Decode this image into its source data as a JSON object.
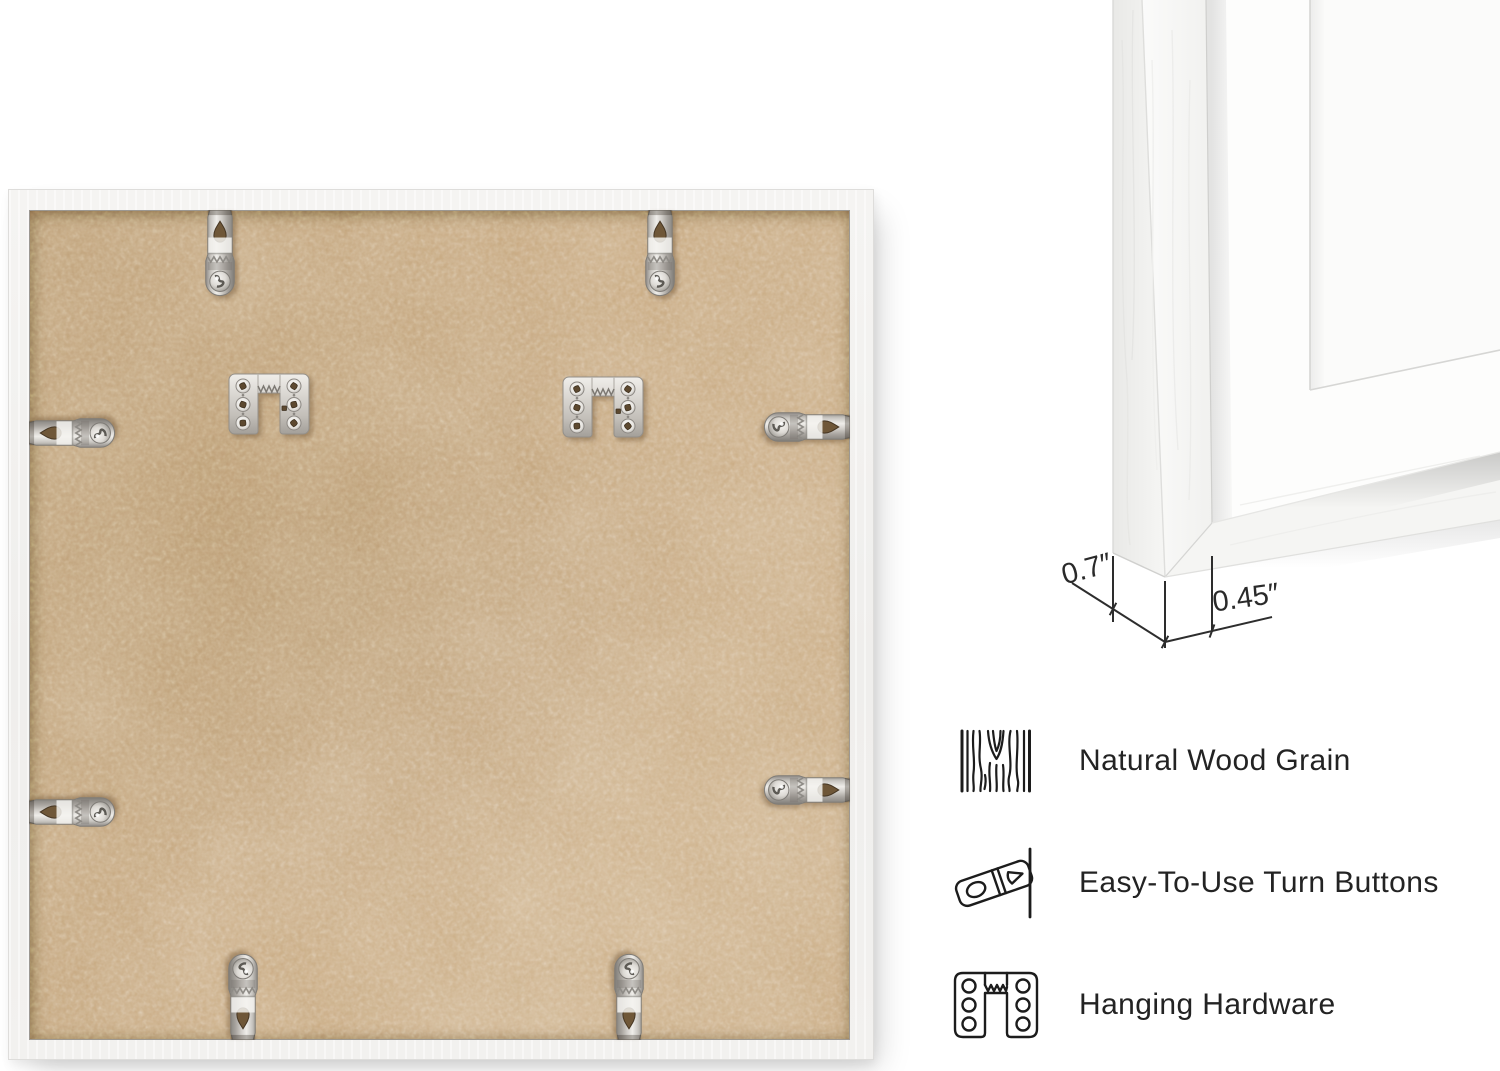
{
  "image_type": "product-infographic",
  "back_view": {
    "description_of_pixels": "rear of square white picture frame with MDF backing",
    "turn_button_count": 8,
    "sawtooth_hanger_count": 2
  },
  "corner_detail": {
    "dimensions": [
      {
        "name": "frame-depth",
        "label": "0.7″"
      },
      {
        "name": "frame-face-width",
        "label": "0.45″"
      }
    ]
  },
  "features": [
    {
      "icon": "wood-grain-icon",
      "label": "Natural Wood Grain"
    },
    {
      "icon": "turn-button-icon",
      "label": "Easy-To-Use Turn Buttons"
    },
    {
      "icon": "hanging-hardware-icon",
      "label": "Hanging Hardware"
    }
  ],
  "colors": {
    "background": "#ffffff",
    "frame_white": "#f3f2f0",
    "mdf_tan": "#c7a87f",
    "metal_silver": "#d6d3ce",
    "line_art": "#1c1c1c",
    "dimension_lines": "#2d2d2d",
    "feature_text": "#232323"
  }
}
